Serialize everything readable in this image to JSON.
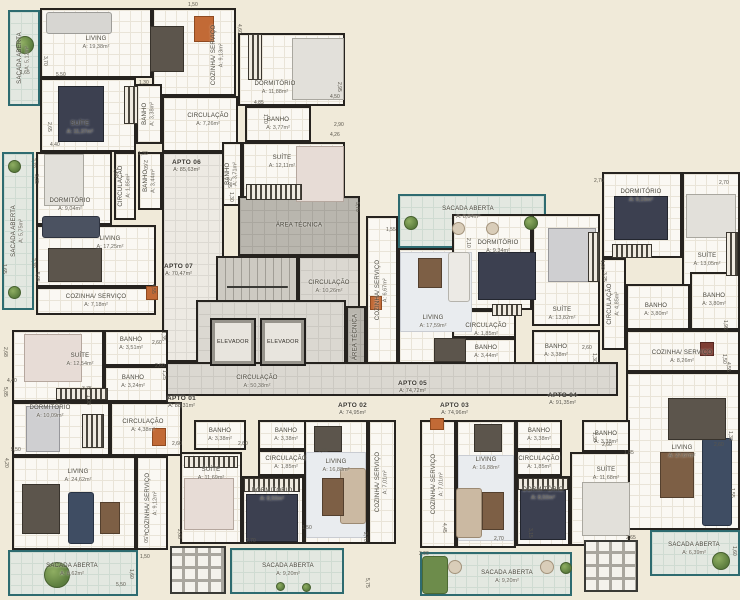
{
  "plan_title": "Planta do pavimento - apartamentos",
  "colors": {
    "background": "#f0ead9",
    "walls": "#26231f",
    "room_floor": "#faf8f3",
    "common_floor": "#dbd8d1",
    "balcony_accent": "#2e6b70",
    "tech_floor": "#b9b6ae"
  },
  "apartments": [
    {
      "label": "APTO 01",
      "area": "A: 88,31m²",
      "x": 167,
      "y": 395
    },
    {
      "label": "APTO 02",
      "area": "A: 74,95m²",
      "x": 338,
      "y": 402
    },
    {
      "label": "APTO 03",
      "area": "A: 74,96m²",
      "x": 440,
      "y": 402
    },
    {
      "label": "APTO 04",
      "area": "A: 91,35m²",
      "x": 548,
      "y": 392
    },
    {
      "label": "APTO 05",
      "area": "A: 74,72m²",
      "x": 398,
      "y": 380
    },
    {
      "label": "APTO 06",
      "area": "A: 85,63m²",
      "x": 172,
      "y": 159
    },
    {
      "label": "APTO 07",
      "area": "A: 70,47m²",
      "x": 164,
      "y": 263
    }
  ],
  "elevators": [
    {
      "label": "ELEVADOR",
      "x": 210,
      "y": 318,
      "w": 46,
      "h": 48
    },
    {
      "label": "ELEVADOR",
      "x": 260,
      "y": 318,
      "w": 46,
      "h": 48
    }
  ],
  "rooms": [
    {
      "n": "SACADA ABERTA",
      "a": "A: 5,12m²",
      "x": 8,
      "y": 10,
      "w": 32,
      "h": 96,
      "k": "sacada",
      "v": 1
    },
    {
      "n": "LIVING",
      "a": "A: 19,38m²",
      "x": 40,
      "y": 8,
      "w": 112,
      "h": 70,
      "k": "room"
    },
    {
      "n": "COZINHA/ SERVIÇO",
      "a": "A: 9,13m²",
      "x": 152,
      "y": 8,
      "w": 84,
      "h": 88,
      "k": "room",
      "v": 1,
      "lx": 218,
      "ly": 55
    },
    {
      "n": "SUÍTE",
      "a": "A: 11,37m²",
      "x": 40,
      "y": 78,
      "w": 96,
      "h": 74,
      "k": "room",
      "lx": 80,
      "ly": 128
    },
    {
      "n": "BANHO",
      "a": "A: 3,38m²",
      "x": 136,
      "y": 84,
      "w": 26,
      "h": 60,
      "k": "room",
      "v": 1
    },
    {
      "n": "CIRCULAÇÃO",
      "a": "A: 7,26m²",
      "x": 162,
      "y": 96,
      "w": 76,
      "h": 56,
      "k": "room",
      "lx": 208,
      "ly": 120
    },
    {
      "n": "DORMITÓRIO",
      "a": "A: 11,88m²",
      "x": 238,
      "y": 33,
      "w": 107,
      "h": 73,
      "k": "room",
      "lx": 275,
      "ly": 88
    },
    {
      "n": "BANHO",
      "a": "A: 3,77m²",
      "x": 245,
      "y": 106,
      "w": 66,
      "h": 36,
      "k": "room"
    },
    {
      "n": "BANHO",
      "a": "A: 3,71m²",
      "x": 222,
      "y": 142,
      "w": 20,
      "h": 64,
      "k": "room",
      "v": 1
    },
    {
      "n": "SUÍTE",
      "a": "A: 12,11m²",
      "x": 242,
      "y": 142,
      "w": 103,
      "h": 64,
      "k": "room",
      "lx": 282,
      "ly": 162
    },
    {
      "n": "SACADA ABERTA",
      "a": "A: 5,75m²",
      "x": 2,
      "y": 152,
      "w": 32,
      "h": 158,
      "k": "sacada",
      "v": 1
    },
    {
      "n": "DORMITÓRIO",
      "a": "A: 9,04m²",
      "x": 36,
      "y": 152,
      "w": 76,
      "h": 73,
      "k": "room",
      "lx": 70,
      "ly": 205
    },
    {
      "n": "CIRCULAÇÃO",
      "a": "A: 1,85m²",
      "x": 114,
      "y": 152,
      "w": 22,
      "h": 68,
      "k": "room",
      "v": 1
    },
    {
      "n": "BANHO",
      "a": "A: 3,44m²",
      "x": 138,
      "y": 152,
      "w": 24,
      "h": 58,
      "k": "room",
      "v": 1
    },
    {
      "n": "LIVING",
      "a": "A: 17,25m²",
      "x": 36,
      "y": 225,
      "w": 120,
      "h": 62,
      "k": "room",
      "lx": 110,
      "ly": 243
    },
    {
      "n": "COZINHA/ SERVIÇO",
      "a": "A: 7,18m²",
      "x": 36,
      "y": 287,
      "w": 120,
      "h": 28,
      "k": "room"
    },
    {
      "n": "",
      "x": 162,
      "y": 152,
      "w": 62,
      "h": 210,
      "k": "corr",
      "dn": "private-corridor"
    },
    {
      "n": "ÁREA TÉCNICA",
      "a": "",
      "x": 238,
      "y": 196,
      "w": 122,
      "h": 60,
      "k": "tech"
    },
    {
      "n": "",
      "x": 216,
      "y": 256,
      "w": 82,
      "h": 62,
      "k": "stairs",
      "dn": "stairs"
    },
    {
      "n": "CIRCULAÇÃO",
      "a": "A: 10,26m²",
      "x": 298,
      "y": 256,
      "w": 62,
      "h": 62,
      "k": "hall"
    },
    {
      "n": "",
      "x": 196,
      "y": 300,
      "w": 150,
      "h": 64,
      "k": "hall",
      "dn": "elevator-lobby"
    },
    {
      "n": "ÁREA TÉCNICA",
      "a": "",
      "x": 346,
      "y": 306,
      "w": 20,
      "h": 62,
      "k": "tech",
      "v": 1
    },
    {
      "n": "CIRCULAÇÃO",
      "a": "A: 50,38m²",
      "x": 163,
      "y": 362,
      "w": 455,
      "h": 34,
      "k": "hall",
      "lx": 257,
      "ly": 382
    },
    {
      "n": "SACADA ABERTA",
      "a": "A: 8,84m²",
      "x": 398,
      "y": 194,
      "w": 148,
      "h": 54,
      "k": "sacada",
      "lx": 468,
      "ly": 213
    },
    {
      "n": "COZINHA/ SERVIÇO",
      "a": "A: 6,67m²",
      "x": 366,
      "y": 216,
      "w": 32,
      "h": 148,
      "k": "room",
      "v": 1
    },
    {
      "n": "LIVING",
      "a": "A: 17,59m²",
      "x": 398,
      "y": 248,
      "w": 102,
      "h": 116,
      "k": "room",
      "lx": 433,
      "ly": 322
    },
    {
      "n": "DORMITÓRIO",
      "a": "A: 9,34m²",
      "x": 452,
      "y": 214,
      "w": 80,
      "h": 96,
      "k": "room",
      "lx": 498,
      "ly": 247
    },
    {
      "n": "CIRCULAÇÃO",
      "a": "A: 1,85m²",
      "x": 452,
      "y": 310,
      "w": 64,
      "h": 28,
      "k": "room",
      "lx": 486,
      "ly": 330
    },
    {
      "n": "BANHO",
      "a": "A: 3,44m²",
      "x": 452,
      "y": 338,
      "w": 64,
      "h": 26,
      "k": "room",
      "lx": 486,
      "ly": 352
    },
    {
      "n": "SUÍTE",
      "a": "A: 13,82m²",
      "x": 532,
      "y": 214,
      "w": 68,
      "h": 112,
      "k": "room",
      "lx": 562,
      "ly": 314
    },
    {
      "n": "BANHO",
      "a": "A: 3,38m²",
      "x": 532,
      "y": 330,
      "w": 68,
      "h": 34,
      "k": "room",
      "lx": 556,
      "ly": 351
    },
    {
      "n": "DORMITÓRIO",
      "a": "A: 9,19m²",
      "x": 602,
      "y": 172,
      "w": 80,
      "h": 86,
      "k": "room",
      "lx": 641,
      "ly": 196
    },
    {
      "n": "SUÍTE",
      "a": "A: 13,05m²",
      "x": 682,
      "y": 172,
      "w": 58,
      "h": 122,
      "k": "room",
      "lx": 707,
      "ly": 260
    },
    {
      "n": "CIRCULAÇÃO",
      "a": "A: 4,85m²",
      "x": 602,
      "y": 258,
      "w": 24,
      "h": 92,
      "k": "room",
      "v": 1
    },
    {
      "n": "BANHO",
      "a": "A: 3,80m²",
      "x": 626,
      "y": 284,
      "w": 64,
      "h": 46,
      "k": "room",
      "lx": 656,
      "ly": 310
    },
    {
      "n": "BANHO",
      "a": "A: 3,80m²",
      "x": 690,
      "y": 272,
      "w": 50,
      "h": 58,
      "k": "room",
      "lx": 714,
      "ly": 300
    },
    {
      "n": "COZINHA/ SERVIÇO",
      "a": "A: 8,26m²",
      "x": 626,
      "y": 330,
      "w": 114,
      "h": 42,
      "k": "room",
      "lx": 682,
      "ly": 357
    },
    {
      "n": "LIVING",
      "a": "A: 27,67m²",
      "x": 626,
      "y": 372,
      "w": 114,
      "h": 158,
      "k": "room",
      "lx": 682,
      "ly": 452
    },
    {
      "n": "SACADA ABERTA",
      "a": "A: 6,39m²",
      "x": 650,
      "y": 530,
      "w": 90,
      "h": 46,
      "k": "sacada",
      "lx": 694,
      "ly": 549
    },
    {
      "n": "COZINHA/ SERVIÇO",
      "a": "A: 7,01m²",
      "x": 420,
      "y": 420,
      "w": 36,
      "h": 128,
      "k": "room",
      "v": 1
    },
    {
      "n": "LIVING",
      "a": "A: 16,88m²",
      "x": 456,
      "y": 420,
      "w": 60,
      "h": 128,
      "k": "room",
      "lx": 486,
      "ly": 464
    },
    {
      "n": "BANHO",
      "a": "A: 3,38m²",
      "x": 516,
      "y": 420,
      "w": 46,
      "h": 30,
      "k": "room"
    },
    {
      "n": "CIRCULAÇÃO",
      "a": "A: 1,85m²",
      "x": 516,
      "y": 450,
      "w": 46,
      "h": 26,
      "k": "room"
    },
    {
      "n": "BANHO",
      "a": "A: 3,38m²",
      "x": 582,
      "y": 420,
      "w": 48,
      "h": 32,
      "k": "room",
      "lx": 606,
      "ly": 438
    },
    {
      "n": "DORMITÓRIO",
      "a": "A: 8,50m²",
      "x": 516,
      "y": 476,
      "w": 54,
      "h": 70,
      "k": "room",
      "lx": 543,
      "ly": 494
    },
    {
      "n": "SUÍTE",
      "a": "A: 11,68m²",
      "x": 570,
      "y": 452,
      "w": 60,
      "h": 94,
      "k": "room",
      "lx": 606,
      "ly": 474
    },
    {
      "n": "SACADA ABERTA",
      "a": "A: 9,20m²",
      "x": 420,
      "y": 552,
      "w": 152,
      "h": 44,
      "k": "sacada",
      "lx": 507,
      "ly": 577
    },
    {
      "n": "SUÍTE",
      "a": "A: 11,69m²",
      "x": 180,
      "y": 452,
      "w": 62,
      "h": 92,
      "k": "room",
      "lx": 211,
      "ly": 474
    },
    {
      "n": "BANHO",
      "a": "A: 3,38m²",
      "x": 194,
      "y": 420,
      "w": 52,
      "h": 30,
      "k": "room"
    },
    {
      "n": "BANHO",
      "a": "A: 3,38m²",
      "x": 258,
      "y": 420,
      "w": 56,
      "h": 30,
      "k": "room"
    },
    {
      "n": "CIRCULAÇÃO",
      "a": "A: 1,85m²",
      "x": 258,
      "y": 450,
      "w": 56,
      "h": 26,
      "k": "room"
    },
    {
      "n": "DORMITÓRIO",
      "a": "A: 8,50m²",
      "x": 242,
      "y": 476,
      "w": 62,
      "h": 68,
      "k": "room",
      "lx": 272,
      "ly": 495
    },
    {
      "n": "LIVING",
      "a": "A: 16,88m²",
      "x": 304,
      "y": 420,
      "w": 64,
      "h": 124,
      "k": "room",
      "lx": 336,
      "ly": 466
    },
    {
      "n": "COZINHA/ SERVIÇO",
      "a": "A: 7,01m²",
      "x": 368,
      "y": 420,
      "w": 28,
      "h": 124,
      "k": "room",
      "v": 1
    },
    {
      "n": "SACADA ABERTA",
      "a": "A: 9,20m²",
      "x": 230,
      "y": 548,
      "w": 114,
      "h": 46,
      "k": "sacada",
      "lx": 288,
      "ly": 570
    },
    {
      "n": "SUÍTE",
      "a": "A: 12,54m²",
      "x": 12,
      "y": 330,
      "w": 92,
      "h": 72,
      "k": "room",
      "lx": 80,
      "ly": 360
    },
    {
      "n": "BANHO",
      "a": "A: 3,51m²",
      "x": 104,
      "y": 330,
      "w": 64,
      "h": 36,
      "k": "room",
      "lx": 131,
      "ly": 344
    },
    {
      "n": "BANHO",
      "a": "A: 3,24m²",
      "x": 104,
      "y": 366,
      "w": 64,
      "h": 36,
      "k": "room",
      "lx": 133,
      "ly": 382
    },
    {
      "n": "DORMITÓRIO",
      "a": "A: 10,09m²",
      "x": 12,
      "y": 402,
      "w": 98,
      "h": 54,
      "k": "room",
      "lx": 50,
      "ly": 412
    },
    {
      "n": "CIRCULAÇÃO",
      "a": "A: 4,38m²",
      "x": 110,
      "y": 402,
      "w": 72,
      "h": 54,
      "k": "room",
      "lx": 143,
      "ly": 426
    },
    {
      "n": "LIVING",
      "a": "A: 24,62m²",
      "x": 12,
      "y": 456,
      "w": 124,
      "h": 94,
      "k": "room",
      "lx": 78,
      "ly": 476
    },
    {
      "n": "COZINHA/ SERVIÇO",
      "a": "A: 9,12m²",
      "x": 136,
      "y": 456,
      "w": 32,
      "h": 94,
      "k": "room",
      "v": 1
    },
    {
      "n": "SACADA ABERTA",
      "a": "A: 8,62m²",
      "x": 8,
      "y": 550,
      "w": 130,
      "h": 46,
      "k": "sacada",
      "lx": 72,
      "ly": 570
    },
    {
      "n": "",
      "x": 170,
      "y": 546,
      "w": 56,
      "h": 48,
      "k": "grid",
      "dn": "pergola-structure"
    },
    {
      "n": "",
      "x": 584,
      "y": 540,
      "w": 54,
      "h": 52,
      "k": "grid",
      "dn": "pergola-structure"
    }
  ],
  "dims": [
    {
      "t": "1,65",
      "x": 20,
      "y": 70
    },
    {
      "t": "3,70",
      "x": 42,
      "y": 56,
      "v": 1
    },
    {
      "t": "5,50",
      "x": 56,
      "y": 72
    },
    {
      "t": "1,50",
      "x": 188,
      "y": 2
    },
    {
      "t": "4,60",
      "x": 236,
      "y": 24,
      "v": 1
    },
    {
      "t": "1,30",
      "x": 139,
      "y": 80
    },
    {
      "t": "2,65",
      "x": 46,
      "y": 122,
      "v": 1
    },
    {
      "t": "4,40",
      "x": 50,
      "y": 142
    },
    {
      "t": "4,85",
      "x": 254,
      "y": 100
    },
    {
      "t": "1,10",
      "x": 262,
      "y": 114,
      "v": 1
    },
    {
      "t": "2,95",
      "x": 336,
      "y": 82,
      "v": 1
    },
    {
      "t": "4,50",
      "x": 330,
      "y": 94
    },
    {
      "t": "2,90",
      "x": 334,
      "y": 122
    },
    {
      "t": "4,26",
      "x": 330,
      "y": 132
    },
    {
      "t": "2,85",
      "x": 226,
      "y": 178,
      "v": 1
    },
    {
      "t": "1,30",
      "x": 228,
      "y": 192,
      "v": 1
    },
    {
      "t": "1,30",
      "x": 138,
      "y": 151
    },
    {
      "t": "2,60",
      "x": 142,
      "y": 160,
      "v": 1
    },
    {
      "t": "2,70",
      "x": 30,
      "y": 158,
      "v": 1
    },
    {
      "t": "3,35",
      "x": 33,
      "y": 174,
      "v": 1
    },
    {
      "t": "1,90",
      "x": 112,
      "y": 168,
      "v": 1
    },
    {
      "t": "2,30",
      "x": 30,
      "y": 258,
      "v": 1
    },
    {
      "t": "5,95",
      "x": 34,
      "y": 272,
      "v": 1
    },
    {
      "t": "4,55",
      "x": 150,
      "y": 284,
      "v": 1
    },
    {
      "t": "1,65",
      "x": 1,
      "y": 264,
      "v": 1
    },
    {
      "t": "5,70",
      "x": 354,
      "y": 202,
      "v": 1
    },
    {
      "t": "2,10",
      "x": 465,
      "y": 238,
      "v": 1
    },
    {
      "t": "1,55",
      "x": 386,
      "y": 227
    },
    {
      "t": "2,70",
      "x": 594,
      "y": 178
    },
    {
      "t": "2,70",
      "x": 719,
      "y": 180
    },
    {
      "t": "1,90",
      "x": 599,
      "y": 260,
      "v": 1
    },
    {
      "t": "3,25",
      "x": 601,
      "y": 272,
      "v": 1
    },
    {
      "t": "1,95",
      "x": 722,
      "y": 320,
      "v": 1
    },
    {
      "t": "1,50",
      "x": 721,
      "y": 354,
      "v": 1
    },
    {
      "t": "4,55",
      "x": 725,
      "y": 362,
      "v": 1
    },
    {
      "t": "2,60",
      "x": 582,
      "y": 345
    },
    {
      "t": "1,30",
      "x": 591,
      "y": 353,
      "v": 1
    },
    {
      "t": "2,68",
      "x": 2,
      "y": 347,
      "v": 1
    },
    {
      "t": "4,40",
      "x": 7,
      "y": 378
    },
    {
      "t": "1,35",
      "x": 160,
      "y": 331,
      "v": 1
    },
    {
      "t": "2,60",
      "x": 152,
      "y": 340
    },
    {
      "t": "2,60",
      "x": 155,
      "y": 363
    },
    {
      "t": "1,25",
      "x": 161,
      "y": 370,
      "v": 1
    },
    {
      "t": "3,75",
      "x": 82,
      "y": 386
    },
    {
      "t": "1,08",
      "x": 85,
      "y": 395,
      "v": 1
    },
    {
      "t": "5,85",
      "x": 2,
      "y": 387,
      "v": 1
    },
    {
      "t": "5,50",
      "x": 11,
      "y": 447
    },
    {
      "t": "4,20",
      "x": 3,
      "y": 458,
      "v": 1
    },
    {
      "t": "4,50",
      "x": 142,
      "y": 533,
      "v": 1
    },
    {
      "t": "1,50",
      "x": 140,
      "y": 554
    },
    {
      "t": "1,60",
      "x": 128,
      "y": 569,
      "v": 1
    },
    {
      "t": "5,50",
      "x": 116,
      "y": 582
    },
    {
      "t": "2,60",
      "x": 172,
      "y": 441
    },
    {
      "t": "2,60",
      "x": 238,
      "y": 441
    },
    {
      "t": "1,85",
      "x": 318,
      "y": 448
    },
    {
      "t": "2,68",
      "x": 176,
      "y": 529,
      "v": 1
    },
    {
      "t": "2,70",
      "x": 246,
      "y": 538
    },
    {
      "t": "1,50",
      "x": 302,
      "y": 525
    },
    {
      "t": "2,70",
      "x": 362,
      "y": 532,
      "v": 1
    },
    {
      "t": "5,75",
      "x": 364,
      "y": 578,
      "v": 1
    },
    {
      "t": "4,45",
      "x": 441,
      "y": 523,
      "v": 1
    },
    {
      "t": "2,90",
      "x": 419,
      "y": 551
    },
    {
      "t": "2,70",
      "x": 494,
      "y": 536
    },
    {
      "t": "3,15",
      "x": 527,
      "y": 528,
      "v": 1
    },
    {
      "t": "1,30",
      "x": 591,
      "y": 432,
      "v": 1
    },
    {
      "t": "2,60",
      "x": 602,
      "y": 442
    },
    {
      "t": "1,30",
      "x": 727,
      "y": 431,
      "v": 1
    },
    {
      "t": "2,60",
      "x": 714,
      "y": 442
    },
    {
      "t": "1,85",
      "x": 624,
      "y": 450
    },
    {
      "t": "2,65",
      "x": 626,
      "y": 535
    },
    {
      "t": "1,55",
      "x": 729,
      "y": 488,
      "v": 1
    },
    {
      "t": "1,60",
      "x": 731,
      "y": 546,
      "v": 1
    }
  ]
}
